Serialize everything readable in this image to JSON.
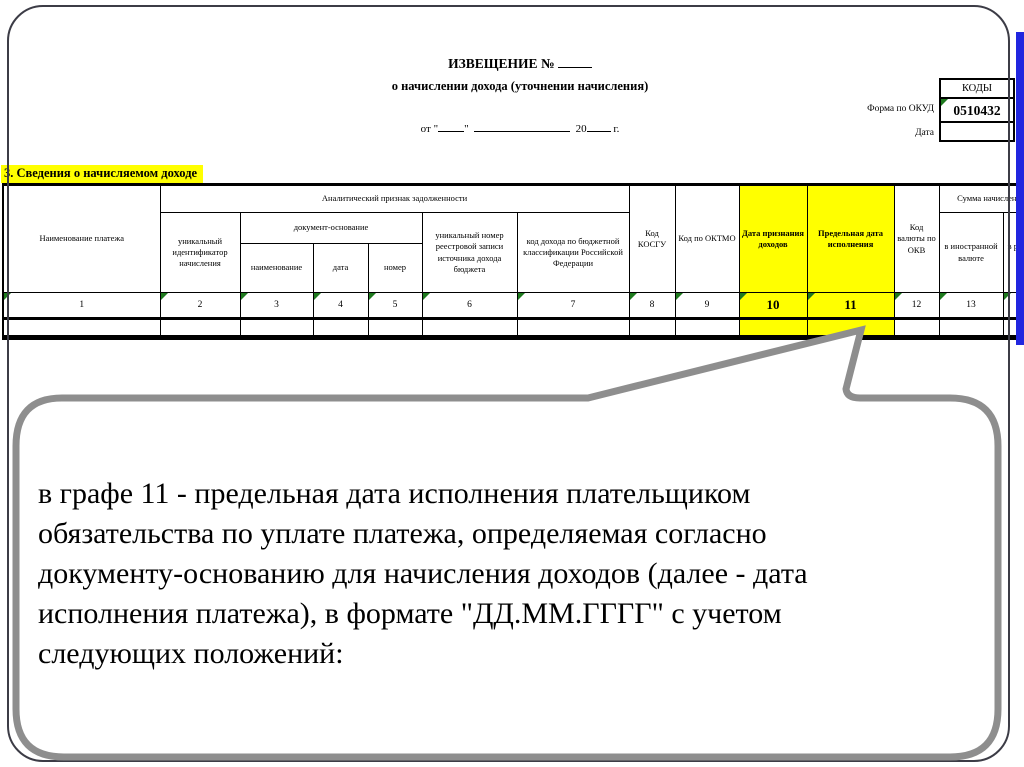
{
  "form": {
    "kody_label": "КОДЫ",
    "okud_label": "Форма по ОКУД",
    "okud_code": "0510432",
    "date_label": "Дата",
    "title_line1": "ИЗВЕЩЕНИЕ №",
    "title_line2": "о начислении дохода (уточнении начисления)",
    "date_parts": [
      "от \"",
      "\"",
      "20",
      "г."
    ]
  },
  "section": {
    "title": "3. Сведения о начисляемом доходе"
  },
  "table": {
    "group_analytic": "Аналитический признак задолженности",
    "group_docbase": "документ-основание",
    "group_sum": "Сумма начисления",
    "col_payment_name": "Наименование платежа",
    "col_uin": "уникальный идентификатор начисления",
    "col_doc_name": "наименование",
    "col_doc_date": "дата",
    "col_doc_number": "номер",
    "col_registry_number": "уникальный номер реестровой записи источника дохода бюджета",
    "col_budget_code": "код дохода по бюджетной классификации Российской Федерации",
    "col_kosgu": "Код КОСГУ",
    "col_oktmo": "Код по ОКТМО",
    "col_income_date": "Дата признания доходов",
    "col_deadline": "Предельная дата исполнения",
    "col_currency": "Код валюты по ОКВ",
    "col_foreign": "в иностранной валюте",
    "col_rub": "в рублях (р",
    "col_numbers": [
      "1",
      "2",
      "3",
      "4",
      "5",
      "6",
      "7",
      "8",
      "9",
      "10",
      "11",
      "12",
      "13",
      "14"
    ]
  },
  "bubble": {
    "lines": [
      "в графе 11 - предельная дата исполнения плательщиком",
      "обязательства по уплате платежа, определяемая согласно",
      "документу-основанию для начисления доходов (далее - дата",
      "исполнения платежа), в формате \"ДД.ММ.ГГГГ\" с учетом",
      "следующих положений:"
    ]
  },
  "colors": {
    "highlight_yellow": "#ffff00",
    "edge_blue": "#2126df",
    "bubble_border_gray": "#8e8e8e",
    "excel_marker_green": "#1e7a1e"
  }
}
